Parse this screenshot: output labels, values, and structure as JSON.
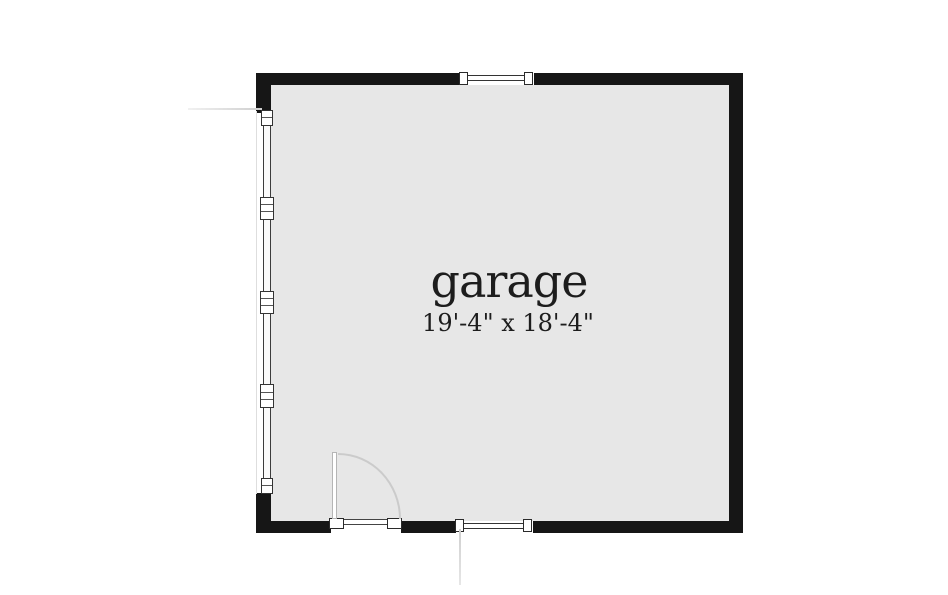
{
  "plan": {
    "title": "garage floor plan",
    "room": {
      "name": "garage",
      "dimensions": "19'-4\" x 18'-4\""
    },
    "features": {
      "door": "hinged entry door in bottom wall, swings into room",
      "window_top_wall": "window centered-right in top wall",
      "window_bottom_wall": "window in bottom wall right of door",
      "left_wall": "window/screen wall band with five mullion markers"
    },
    "colors": {
      "wall": "#161616",
      "floor": "#e7e7e7",
      "background": "#ffffff",
      "frame_line": "#3c3c3c",
      "door_swing": "#cbcbcb",
      "reference_line": "#d7d7d7",
      "text": "#1d1d1d"
    }
  }
}
